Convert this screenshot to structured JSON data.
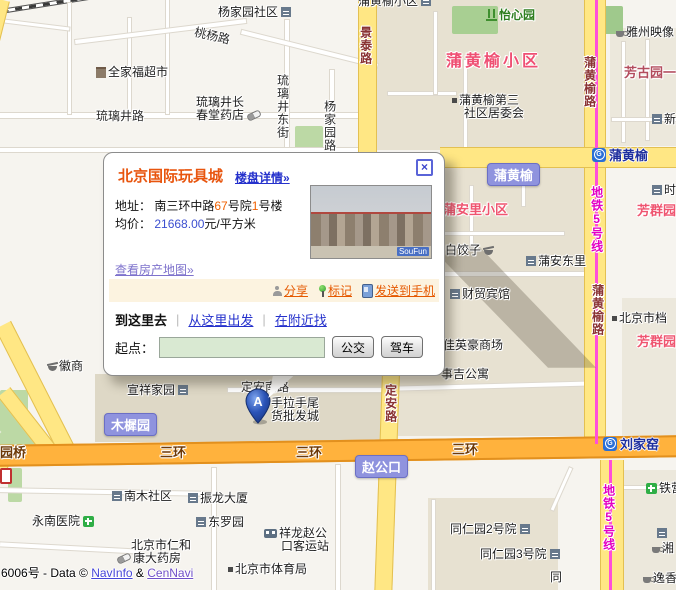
{
  "popup": {
    "title": "北京国际玩具城",
    "detail_link": "楼盘详情»",
    "close_glyph": "×",
    "address_label": "地址：",
    "address": {
      "p1": "南三环中路",
      "n1": "67",
      "p2": "号院",
      "n2": "1",
      "p3": "号楼"
    },
    "price_label": "均价：",
    "price_value": "21668.00",
    "price_unit": "元/平方米",
    "photo_watermark": "SouFun",
    "property_map_link": "查看房产地图»",
    "share_link": "分享",
    "mark_link": "标记",
    "send_link": "发送到手机",
    "go_here": "到这里去",
    "from_here": "从这里出发",
    "find_nearby": "在附近找",
    "separator": "|",
    "start_label": "起点：",
    "start_value": "",
    "bus_button": "公交",
    "drive_button": "驾车"
  },
  "marker": {
    "label": "A"
  },
  "icons": {
    "metro_logo": "G"
  },
  "attribution": {
    "prefix": "6006号 - Data © ",
    "navinfo": "NavInfo",
    "sep": " & ",
    "cennavi": "CenNavi"
  },
  "colors": {
    "ring_road": "#ffb23d",
    "minor_road": "#ffe784",
    "metro_line": "#ff4fd8",
    "badge_purple": "#8f93de",
    "station_blue": "#2a6fd6",
    "area_label_red": "#ef5570",
    "popup_title_orange": "#e8550e"
  },
  "map": {
    "stations": [
      {
        "n": "metro-station-puhuangyu",
        "t": "蒲黄榆",
        "x": 592,
        "y": 145
      },
      {
        "n": "metro-station-liujiayao",
        "t": "刘家窑",
        "x": 603,
        "y": 434
      }
    ],
    "badges": [
      {
        "n": "place-badge-puhuangyu",
        "t": "蒲黄榆",
        "x": 487,
        "y": 163
      },
      {
        "n": "place-badge-muxiyuan",
        "t": "木樨园",
        "x": 104,
        "y": 413
      },
      {
        "n": "place-badge-zhaogongkou",
        "t": "赵公口",
        "x": 355,
        "y": 455
      }
    ],
    "labels": [
      {
        "t": "杨家园社区",
        "x": 218,
        "y": 6,
        "c": "poi",
        "ia": "bld"
      },
      {
        "t": "桃杨路",
        "x": 196,
        "y": 26,
        "c": "road",
        "r": 13
      },
      {
        "t": "全家福超市",
        "x": 96,
        "y": 66,
        "c": "poi",
        "ib": "shop"
      },
      {
        "t": "琉璃井长",
        "x": 196,
        "y": 96,
        "c": "poi"
      },
      {
        "t": "春堂药店",
        "x": 196,
        "y": 109,
        "c": "poi",
        "ia": "pill"
      },
      {
        "t": "琉璃井路",
        "x": 96,
        "y": 110,
        "c": "road"
      },
      {
        "t": "琉璃井东街",
        "x": 276,
        "y": 74,
        "c": "road",
        "v": 1
      },
      {
        "t": "杨家园路",
        "x": 323,
        "y": 100,
        "c": "road",
        "v": 1
      },
      {
        "t": "蒲黄榆小区",
        "x": 358,
        "y": -5,
        "c": "poi",
        "ia": "bld"
      },
      {
        "t": "怡心园",
        "x": 486,
        "y": 9,
        "c": "green",
        "ib": "park"
      },
      {
        "t": "雅州映像",
        "x": 616,
        "y": 26,
        "c": "poi",
        "ib": "cup"
      },
      {
        "t": "芳古园一区",
        "x": 624,
        "y": 66,
        "c": "redsm"
      },
      {
        "t": "景泰路",
        "x": 359,
        "y": 26,
        "c": "yroad",
        "v": 1
      },
      {
        "t": "蒲黄榆小区",
        "x": 446,
        "y": 54,
        "c": "redbig"
      },
      {
        "t": "蒲黄榆第三",
        "x": 452,
        "y": 94,
        "c": "poi",
        "ib": "sq"
      },
      {
        "t": "社区居委会",
        "x": 464,
        "y": 107,
        "c": "poi"
      },
      {
        "t": "蒲黄榆路",
        "x": 583,
        "y": 56,
        "c": "yroad",
        "v": 1
      },
      {
        "t": "新",
        "x": 652,
        "y": 113,
        "c": "poi",
        "ib": "bld"
      },
      {
        "t": "地铁5号线",
        "x": 590,
        "y": 186,
        "c": "metro",
        "v": 1
      },
      {
        "t": "蒲安里小区",
        "x": 443,
        "y": 203,
        "c": "red"
      },
      {
        "t": "芳群园",
        "x": 637,
        "y": 204,
        "c": "red"
      },
      {
        "t": "时",
        "x": 652,
        "y": 184,
        "c": "poi",
        "ib": "bld"
      },
      {
        "t": "白饺子",
        "x": 445,
        "y": 244,
        "c": "poi",
        "ia": "bowl"
      },
      {
        "t": "蒲安东里",
        "x": 526,
        "y": 255,
        "c": "poi",
        "ib": "bld"
      },
      {
        "t": "财贸宾馆",
        "x": 450,
        "y": 288,
        "c": "poi",
        "ib": "bld"
      },
      {
        "t": "蒲黄榆路",
        "x": 591,
        "y": 284,
        "c": "yroad",
        "v": 1
      },
      {
        "t": "北京市档",
        "x": 612,
        "y": 312,
        "c": "poi",
        "ib": "sq"
      },
      {
        "t": "芳群园三区",
        "x": 637,
        "y": 335,
        "c": "red"
      },
      {
        "t": "佳英豪商场",
        "x": 443,
        "y": 339,
        "c": "poi"
      },
      {
        "t": "事吉公寓",
        "x": 441,
        "y": 368,
        "c": "poi"
      },
      {
        "t": "徽商",
        "x": 48,
        "y": 360,
        "c": "poi",
        "ib": "bowl"
      },
      {
        "t": "宣祥家园",
        "x": 127,
        "y": 384,
        "c": "poi",
        "ia": "bld"
      },
      {
        "t": "定安南路",
        "x": 241,
        "y": 381,
        "c": "road"
      },
      {
        "t": "手拉手尾",
        "x": 271,
        "y": 397,
        "c": "poi"
      },
      {
        "t": "货批发城",
        "x": 271,
        "y": 410,
        "c": "poi"
      },
      {
        "t": "定安路",
        "x": 384,
        "y": 384,
        "c": "yroad",
        "v": 1
      },
      {
        "t": "三环",
        "x": 160,
        "y": 446,
        "c": "ring"
      },
      {
        "t": "三环",
        "x": 296,
        "y": 446,
        "c": "ring"
      },
      {
        "t": "三环",
        "x": 452,
        "y": 443,
        "c": "ring"
      },
      {
        "t": "园桥",
        "x": 0,
        "y": 446,
        "c": "ring"
      },
      {
        "t": "地铁5号线",
        "x": 602,
        "y": 484,
        "c": "metro",
        "v": 1
      },
      {
        "t": "铁营",
        "x": 646,
        "y": 482,
        "c": "poi",
        "ib": "cross"
      },
      {
        "t": "南木社区",
        "x": 112,
        "y": 490,
        "c": "poi",
        "ib": "bld"
      },
      {
        "t": "振龙大厦",
        "x": 188,
        "y": 492,
        "c": "poi",
        "ib": "bld"
      },
      {
        "t": "东罗园",
        "x": 196,
        "y": 516,
        "c": "poi",
        "ib": "bld"
      },
      {
        "t": "永南医院",
        "x": 32,
        "y": 515,
        "c": "poi",
        "ia": "cross"
      },
      {
        "t": "祥龙赵公",
        "x": 264,
        "y": 527,
        "c": "poi",
        "ib": "bus"
      },
      {
        "t": "口客运站",
        "x": 281,
        "y": 540,
        "c": "poi"
      },
      {
        "t": "北京市仁和",
        "x": 131,
        "y": 539,
        "c": "poi"
      },
      {
        "t": "康大药房",
        "x": 117,
        "y": 552,
        "c": "poi",
        "ib": "pill"
      },
      {
        "t": "北京市体育局",
        "x": 228,
        "y": 563,
        "c": "poi",
        "ib": "sq"
      },
      {
        "t": "同仁园2号院",
        "x": 450,
        "y": 523,
        "c": "poi",
        "ia": "bld"
      },
      {
        "t": "同仁园3号院",
        "x": 480,
        "y": 548,
        "c": "poi",
        "ia": "bld"
      },
      {
        "t": "同",
        "x": 550,
        "y": 571,
        "c": "poi"
      },
      {
        "t": "",
        "x": 657,
        "y": 528,
        "c": "poi",
        "ib": "bld"
      },
      {
        "t": "湘",
        "x": 652,
        "y": 542,
        "c": "poi",
        "ib": "cup"
      },
      {
        "t": "逸香",
        "x": 643,
        "y": 572,
        "c": "poi",
        "ib": "cup"
      },
      {
        "t": "",
        "x": 0,
        "y": 468,
        "c": "poi",
        "ib": "sign"
      }
    ]
  }
}
